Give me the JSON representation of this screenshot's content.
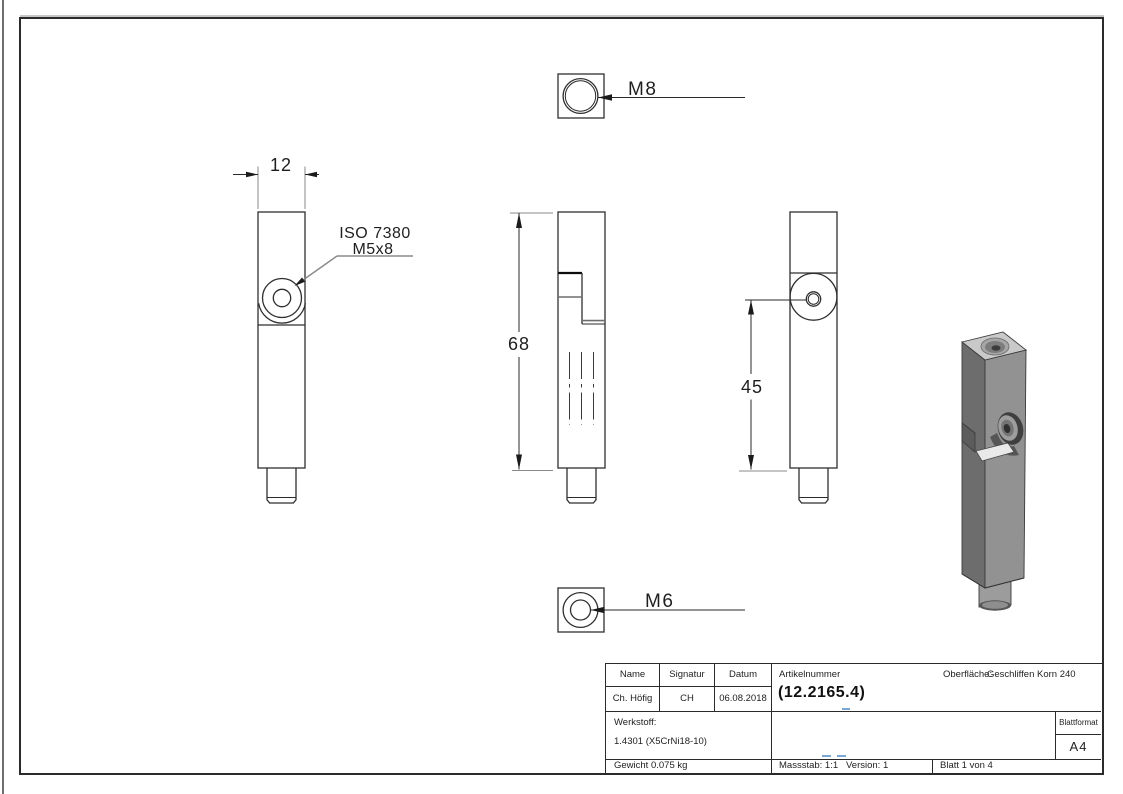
{
  "document": {
    "type": "technical drawing",
    "sheet_format": "A4"
  },
  "views": {
    "top": {
      "thread_label": "M8"
    },
    "left": {
      "width_dim": "12",
      "screw_spec_line1": "ISO 7380",
      "screw_spec_line2": "M5x8"
    },
    "front": {
      "height_dim": "68"
    },
    "right": {
      "hole_position_dim": "45"
    },
    "bottom": {
      "thread_label": "M6"
    }
  },
  "title_block": {
    "headers": {
      "name": "Name",
      "signatur": "Signatur",
      "datum": "Datum"
    },
    "values": {
      "name": "Ch. Höfig",
      "signatur": "CH",
      "datum": "06.08.2018"
    },
    "artikelnummer_label": "Artikelnummer",
    "artikelnummer_value": "(12.2165.4)",
    "oberflaeche_label": "Oberfläche:",
    "oberflaeche_value": "Geschliffen Korn 240",
    "werkstoff_label": "Werkstoff:",
    "werkstoff_value": "1.4301 (X5CrNi18-10)",
    "blattformat_label": "Blattformat",
    "blattformat_value": "A4",
    "gewicht": "Gewicht 0.075 kg",
    "massstab": "Massstab: 1:1",
    "version": "Version: 1",
    "blatt": "Blatt 1 von 4"
  },
  "colors": {
    "line": "#2f2f2f",
    "aux_line": "#8a8a8a",
    "placeholder_dash": "#7aa7d6",
    "solid_top_face": "#c9c9c9",
    "solid_left_face": "#6d6d6d",
    "solid_right_face": "#929292"
  }
}
